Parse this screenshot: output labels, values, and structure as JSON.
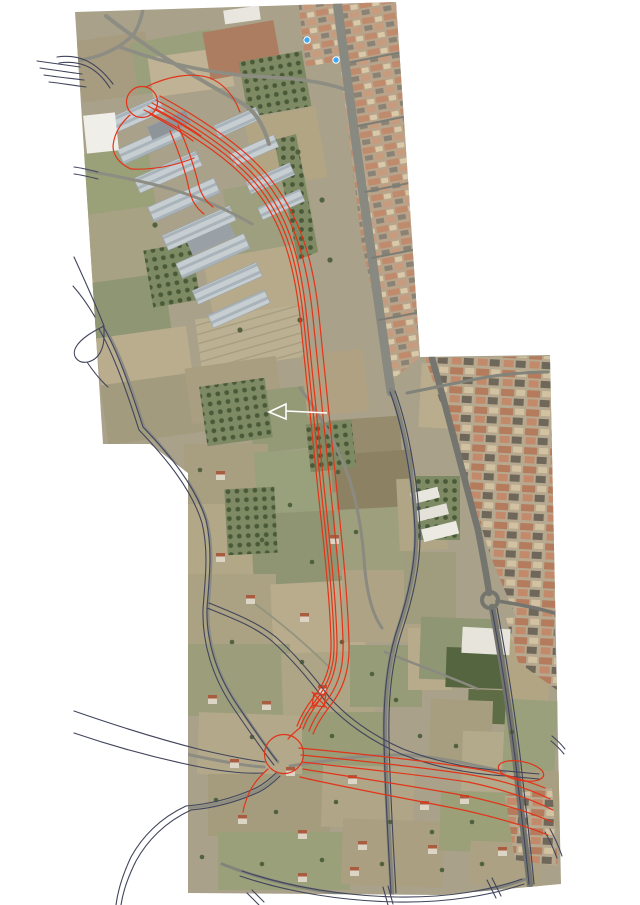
{
  "page": {
    "background": "#ffffff",
    "description": "Aerial orthophoto mosaic with proposed road alignment design overlay"
  },
  "overlay": {
    "alignment_color": "#e23419",
    "vector_road_color": "#41455c",
    "annotation_arrow_color": "#ffffff"
  },
  "markers": {
    "color": "#3fa9f5"
  }
}
